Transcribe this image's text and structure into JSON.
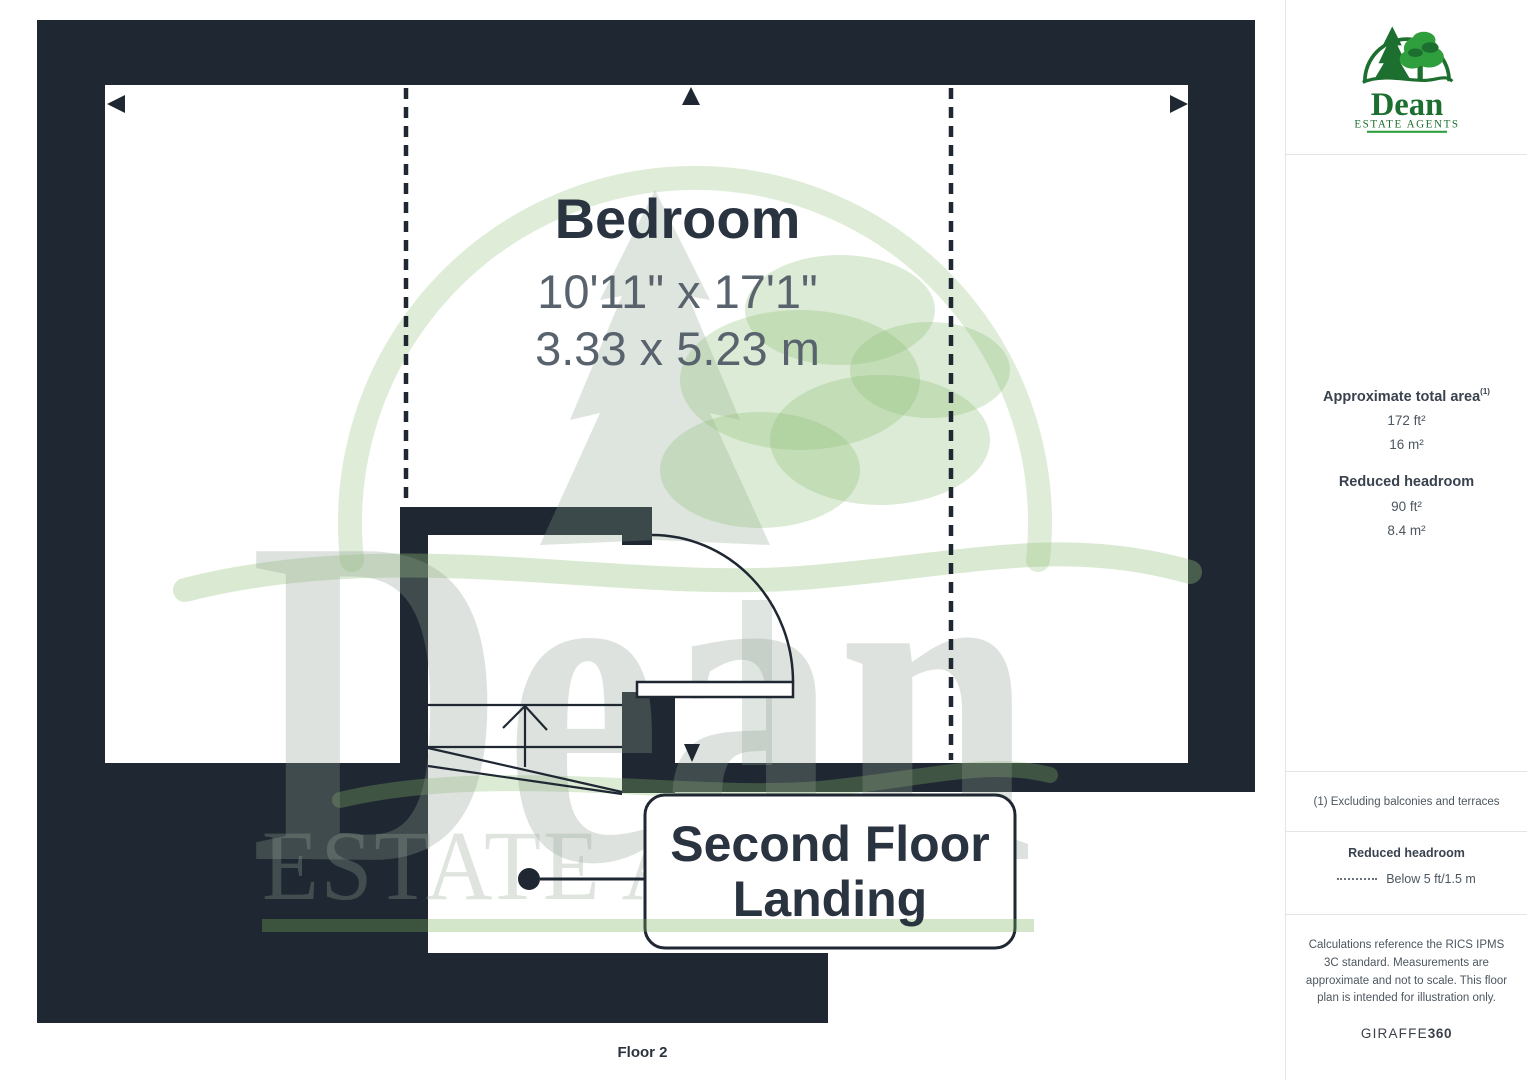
{
  "watermark": {
    "brand": "Dean",
    "tagline": "ESTATE AGENTS"
  },
  "plan": {
    "room": {
      "name": "Bedroom",
      "dims_imperial": "10'11\" x 17'1\"",
      "dims_metric": "3.33 x 5.23 m"
    },
    "landing": {
      "line1": "Second Floor",
      "line2": "Landing"
    },
    "floor_label": "Floor 2"
  },
  "sidebar": {
    "logo": {
      "brand": "Dean",
      "tagline": "ESTATE AGENTS"
    },
    "area": {
      "title": "Approximate total area",
      "title_sup": "(1)",
      "total_ft": "172 ft²",
      "total_m": "16 m²",
      "reduced_title": "Reduced headroom",
      "reduced_ft": "90 ft²",
      "reduced_m": "8.4 m²"
    },
    "footnote": "(1) Excluding balconies and terraces",
    "legend": {
      "title": "Reduced headroom",
      "item": "Below 5 ft/1.5 m"
    },
    "disclaimer": "Calculations reference the RICS IPMS 3C standard. Measurements are approximate and not to scale. This floor plan is intended for illustration only.",
    "footer": {
      "brand": "GIRAFFE",
      "brand_bold": "360"
    }
  },
  "colors": {
    "wall": "#1f2732",
    "ink": "#2a3340",
    "dim": "#59636d",
    "green-dark": "#1c6f2e",
    "green-bright": "#2f9e3d",
    "border": "#e4e4e4",
    "side-text": "#39424e",
    "side-soft": "#4c565f"
  }
}
